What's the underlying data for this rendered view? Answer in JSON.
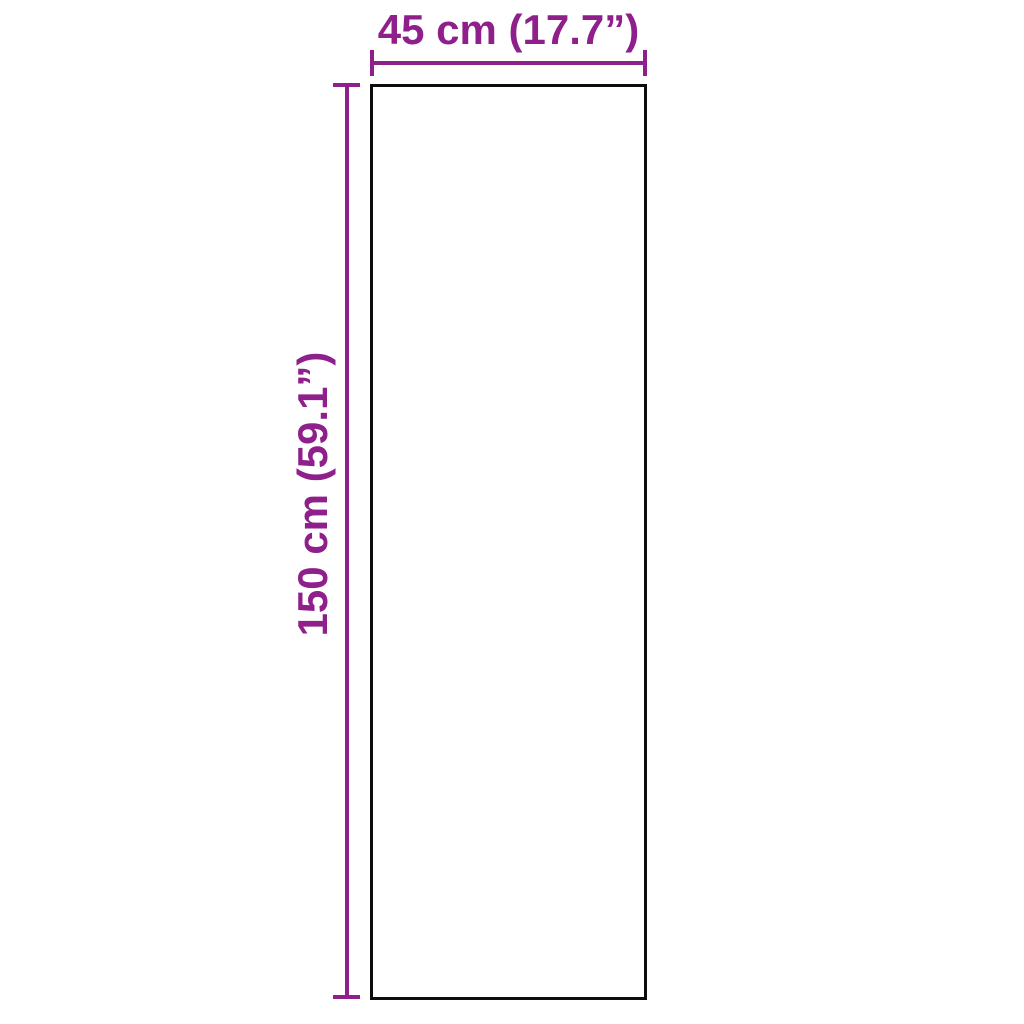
{
  "diagram": {
    "width_label": "45 cm (17.7”)",
    "height_label": "150 cm (59.1”)",
    "width_cm": 45,
    "width_inches": 17.7,
    "height_cm": 150,
    "height_inches": 59.1
  },
  "colors": {
    "dimension": "#8E1F8B",
    "outline": "#0d0d0d",
    "background": "#ffffff"
  }
}
